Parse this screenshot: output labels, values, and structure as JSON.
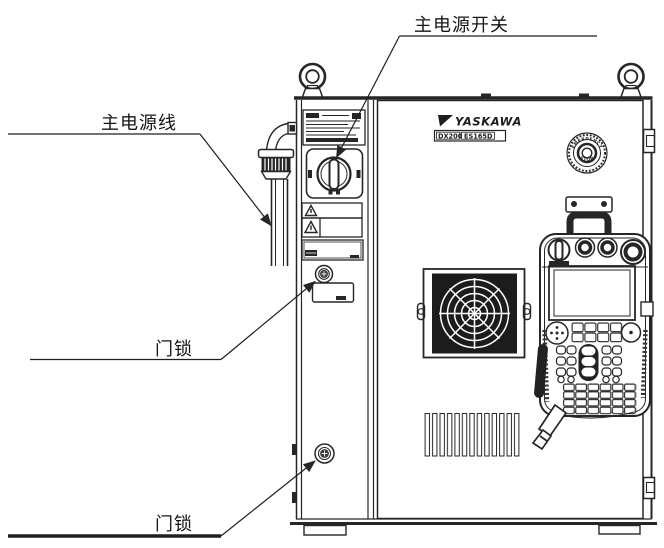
{
  "diagram": {
    "callouts": {
      "main_power_switch": "主电源开关",
      "main_power_cable": "主电源线",
      "door_lock_upper": "门锁",
      "door_lock_lower": "门锁"
    },
    "cabinet": {
      "brand": "YASKAWA",
      "model_series": "DX200",
      "model_number": "ES165D",
      "estop_text_top": "EMERGENCY",
      "estop_text_bottom": "STOP"
    },
    "colors": {
      "line": "#262626",
      "background": "#ffffff"
    }
  }
}
